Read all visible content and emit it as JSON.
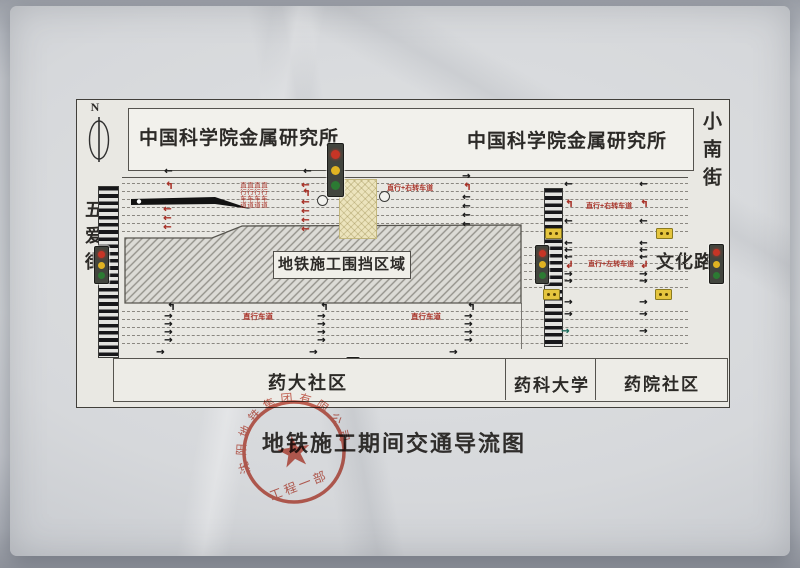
{
  "compass": {
    "label": "N"
  },
  "buildings": {
    "left": "中国科学院金属研究所",
    "right": "中国科学院金属研究所"
  },
  "streets": {
    "west_vertical": "五爱街",
    "east_vertical": "小南街",
    "east_road": "文化路"
  },
  "construction_zone": {
    "label": "地铁施工围挡区域"
  },
  "lane_labels": {
    "north_vertical": [
      "直行车道",
      "直行车道",
      "直行车道",
      "直行车道"
    ],
    "north_mid": "直行+右转车道",
    "north_east": "直行+右转车道",
    "wenhua_west": "直行+左转车道",
    "south_west": "直行车道",
    "south_mid": "直行车道"
  },
  "bottom_places": {
    "left": "药大社区",
    "middle": "药科大学",
    "right": "药院社区"
  },
  "caption": {
    "title": "地铁施工期间交通导流图"
  },
  "stamp": {
    "ring_text": "沈阳地铁集团有限公司",
    "dept": "工程一部",
    "star": "★"
  },
  "icons": {
    "arrow_left": "←",
    "arrow_right": "→",
    "turn_up_left": "↰",
    "turn_down_left": "↲"
  },
  "colors": {
    "lane_red": "#a83228",
    "signal_red": "#c63526",
    "signal_yellow": "#e0b322",
    "signal_green": "#2c7a33",
    "stamp_red": "#c2402f",
    "crosswalk_black": "#17171a",
    "hatch_yellow": "#ece4bd"
  }
}
